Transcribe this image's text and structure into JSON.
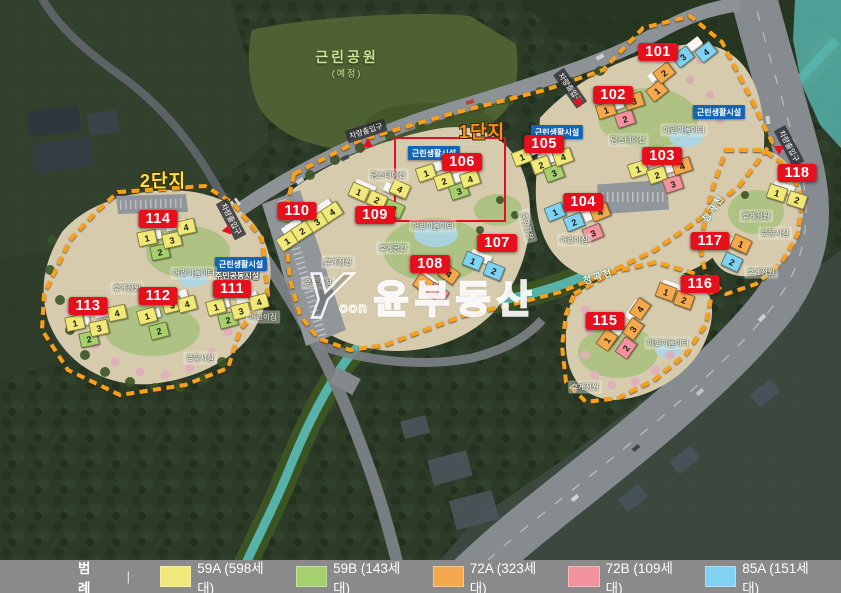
{
  "legend": {
    "title": "범례",
    "divider": "|",
    "items": [
      {
        "code": "59A",
        "label": "59A (598세대)",
        "color": "#f0e878"
      },
      {
        "code": "59B",
        "label": "59B (143세대)",
        "color": "#a6cf6d"
      },
      {
        "code": "72A",
        "label": "72A (323세대)",
        "color": "#f5a94e"
      },
      {
        "code": "72B",
        "label": "72B (109세대)",
        "color": "#f2929e"
      },
      {
        "code": "85A",
        "label": "85A (151세대)",
        "color": "#80d2f2"
      }
    ]
  },
  "watermark": {
    "logo": "Y",
    "logo_sub": "oon",
    "text": "윤부동산"
  },
  "type_colors": {
    "59A": "#f0e878",
    "59B": "#a6cf6d",
    "72A": "#f5a94e",
    "72B": "#f2929e",
    "85A": "#80d2f2"
  },
  "highlight": {
    "building": "106",
    "x": 394,
    "y": 137,
    "w": 108,
    "h": 81,
    "color": "#e6101d"
  },
  "badge_color": "#e6101d",
  "boundary_color": "#f7a01d",
  "buildings": [
    {
      "id": "101",
      "badge": [
        658,
        52
      ],
      "angle": -38,
      "units": [
        {
          "n": "1",
          "t": "72A",
          "x": 657,
          "y": 91
        },
        {
          "n": "2",
          "t": "72A",
          "x": 664,
          "y": 73
        },
        {
          "n": "3",
          "t": "85A",
          "x": 683,
          "y": 57
        },
        {
          "n": "4",
          "t": "85A",
          "x": 706,
          "y": 52
        }
      ]
    },
    {
      "id": "102",
      "badge": [
        613,
        95
      ],
      "angle": -18,
      "units": [
        {
          "n": "1",
          "t": "72A",
          "x": 606,
          "y": 110
        },
        {
          "n": "2",
          "t": "72B",
          "x": 625,
          "y": 119
        },
        {
          "n": "3",
          "t": "72A",
          "x": 634,
          "y": 101
        }
      ]
    },
    {
      "id": "103",
      "badge": [
        662,
        156
      ],
      "angle": -18,
      "units": [
        {
          "n": "1",
          "t": "59A",
          "x": 638,
          "y": 169
        },
        {
          "n": "2",
          "t": "59A",
          "x": 657,
          "y": 175
        },
        {
          "n": "3",
          "t": "72B",
          "x": 673,
          "y": 184
        },
        {
          "n": "4",
          "t": "72A",
          "x": 682,
          "y": 166
        }
      ]
    },
    {
      "id": "104",
      "badge": [
        583,
        202
      ],
      "angle": -22,
      "units": [
        {
          "n": "1",
          "t": "85A",
          "x": 555,
          "y": 212
        },
        {
          "n": "2",
          "t": "85A",
          "x": 574,
          "y": 222
        },
        {
          "n": "3",
          "t": "72B",
          "x": 593,
          "y": 233
        },
        {
          "n": "4",
          "t": "72A",
          "x": 600,
          "y": 212
        }
      ]
    },
    {
      "id": "105",
      "badge": [
        544,
        144
      ],
      "angle": -20,
      "units": [
        {
          "n": "1",
          "t": "59A",
          "x": 522,
          "y": 157
        },
        {
          "n": "2",
          "t": "59A",
          "x": 541,
          "y": 165
        },
        {
          "n": "3",
          "t": "59B",
          "x": 554,
          "y": 173
        },
        {
          "n": "4",
          "t": "59A",
          "x": 563,
          "y": 157
        }
      ]
    },
    {
      "id": "106",
      "badge": [
        462,
        162
      ],
      "angle": -18,
      "units": [
        {
          "n": "1",
          "t": "59A",
          "x": 426,
          "y": 173
        },
        {
          "n": "2",
          "t": "59A",
          "x": 444,
          "y": 181
        },
        {
          "n": "3",
          "t": "59B",
          "x": 459,
          "y": 191
        },
        {
          "n": "4",
          "t": "59A",
          "x": 470,
          "y": 179
        }
      ]
    },
    {
      "id": "107",
      "badge": [
        497,
        243
      ],
      "angle": 22,
      "units": [
        {
          "n": "1",
          "t": "85A",
          "x": 473,
          "y": 261
        },
        {
          "n": "2",
          "t": "85A",
          "x": 494,
          "y": 271
        }
      ]
    },
    {
      "id": "108",
      "badge": [
        430,
        264
      ],
      "angle": 35,
      "units": [
        {
          "n": "1",
          "t": "72A",
          "x": 424,
          "y": 284
        },
        {
          "n": "3",
          "t": "72B",
          "x": 438,
          "y": 293
        },
        {
          "n": "4",
          "t": "72A",
          "x": 449,
          "y": 274
        }
      ]
    },
    {
      "id": "109",
      "badge": [
        375,
        215
      ],
      "angle": 24,
      "units": [
        {
          "n": "1",
          "t": "59A",
          "x": 359,
          "y": 192
        },
        {
          "n": "2",
          "t": "59A",
          "x": 377,
          "y": 200
        },
        {
          "n": "3",
          "t": "59B",
          "x": 394,
          "y": 209
        },
        {
          "n": "4",
          "t": "59A",
          "x": 400,
          "y": 189
        }
      ]
    },
    {
      "id": "110",
      "badge": [
        297,
        211
      ],
      "angle": -33,
      "units": [
        {
          "n": "1",
          "t": "59A",
          "x": 287,
          "y": 241
        },
        {
          "n": "2",
          "t": "59A",
          "x": 302,
          "y": 231
        },
        {
          "n": "3",
          "t": "59A",
          "x": 317,
          "y": 222
        },
        {
          "n": "4",
          "t": "59A",
          "x": 332,
          "y": 212
        }
      ]
    },
    {
      "id": "111",
      "badge": [
        232,
        289
      ],
      "angle": -15,
      "units": [
        {
          "n": "1",
          "t": "59A",
          "x": 216,
          "y": 307
        },
        {
          "n": "2",
          "t": "59B",
          "x": 228,
          "y": 320
        },
        {
          "n": "3",
          "t": "59A",
          "x": 241,
          "y": 311
        },
        {
          "n": "4",
          "t": "59A",
          "x": 259,
          "y": 302
        }
      ]
    },
    {
      "id": "112",
      "badge": [
        158,
        296
      ],
      "angle": -15,
      "units": [
        {
          "n": "1",
          "t": "59A",
          "x": 147,
          "y": 316
        },
        {
          "n": "2",
          "t": "59B",
          "x": 159,
          "y": 331
        },
        {
          "n": "3",
          "t": "59A",
          "x": 172,
          "y": 305
        },
        {
          "n": "4",
          "t": "59A",
          "x": 187,
          "y": 304
        }
      ]
    },
    {
      "id": "113",
      "badge": [
        88,
        306
      ],
      "angle": -12,
      "units": [
        {
          "n": "1",
          "t": "59A",
          "x": 75,
          "y": 323
        },
        {
          "n": "2",
          "t": "59B",
          "x": 89,
          "y": 339
        },
        {
          "n": "3",
          "t": "59A",
          "x": 99,
          "y": 328
        },
        {
          "n": "4",
          "t": "59A",
          "x": 117,
          "y": 313
        }
      ]
    },
    {
      "id": "114",
      "badge": [
        158,
        219
      ],
      "angle": -12,
      "units": [
        {
          "n": "1",
          "t": "59A",
          "x": 147,
          "y": 238
        },
        {
          "n": "2",
          "t": "59B",
          "x": 160,
          "y": 252
        },
        {
          "n": "3",
          "t": "59A",
          "x": 172,
          "y": 240
        },
        {
          "n": "4",
          "t": "59A",
          "x": 186,
          "y": 227
        }
      ]
    },
    {
      "id": "115",
      "badge": [
        605,
        321
      ],
      "angle": -55,
      "units": [
        {
          "n": "1",
          "t": "72A",
          "x": 607,
          "y": 340
        },
        {
          "n": "2",
          "t": "72B",
          "x": 626,
          "y": 348
        },
        {
          "n": "3",
          "t": "72A",
          "x": 633,
          "y": 329
        },
        {
          "n": "4",
          "t": "72A",
          "x": 640,
          "y": 309
        }
      ]
    },
    {
      "id": "116",
      "badge": [
        700,
        284
      ],
      "angle": 20,
      "units": [
        {
          "n": "1",
          "t": "72A",
          "x": 666,
          "y": 292
        },
        {
          "n": "2",
          "t": "72A",
          "x": 684,
          "y": 300
        }
      ]
    },
    {
      "id": "117",
      "badge": [
        710,
        241
      ],
      "angle": 25,
      "units": [
        {
          "n": "1",
          "t": "72A",
          "x": 741,
          "y": 244
        },
        {
          "n": "2",
          "t": "85A",
          "x": 732,
          "y": 262
        }
      ]
    },
    {
      "id": "118",
      "badge": [
        797,
        173
      ],
      "angle": 18,
      "units": [
        {
          "n": "1",
          "t": "59A",
          "x": 777,
          "y": 193
        },
        {
          "n": "2",
          "t": "59A",
          "x": 797,
          "y": 200
        }
      ]
    }
  ],
  "map_labels": [
    {
      "text": "2단지",
      "type": "zone2",
      "x": 163,
      "y": 180
    },
    {
      "text": "1단지",
      "type": "zone1",
      "x": 482,
      "y": 131
    },
    {
      "text": "근린공원",
      "type": "park",
      "x": 347,
      "y": 57
    },
    {
      "text": "(예정)",
      "type": "park-sub",
      "x": 347,
      "y": 73
    },
    {
      "text": "차량출입구",
      "type": "entrance",
      "x": 231,
      "y": 219,
      "rot": 62
    },
    {
      "text": "차량출입구",
      "type": "entrance",
      "x": 366,
      "y": 131,
      "rot": -18
    },
    {
      "text": "차량출입구",
      "type": "entrance",
      "x": 570,
      "y": 88,
      "rot": 55
    },
    {
      "text": "차량출입구",
      "type": "entrance",
      "x": 789,
      "y": 146,
      "rot": 62
    },
    {
      "text": "근린생활시설",
      "type": "facility",
      "x": 241,
      "y": 264
    },
    {
      "text": "근린생활시설",
      "type": "facility",
      "x": 434,
      "y": 153
    },
    {
      "text": "근린생활시설",
      "type": "facility",
      "x": 557,
      "y": 132
    },
    {
      "text": "근린생활시설",
      "type": "facility",
      "x": 719,
      "y": 112
    },
    {
      "text": "주민공동시설",
      "type": "outline",
      "x": 237,
      "y": 276
    },
    {
      "text": "어린이놀이터",
      "type": "ground",
      "x": 194,
      "y": 273
    },
    {
      "text": "어린이놀이터",
      "type": "ground",
      "x": 433,
      "y": 226
    },
    {
      "text": "어린이놀이터",
      "type": "ground",
      "x": 684,
      "y": 130
    },
    {
      "text": "어린이놀이터",
      "type": "ground",
      "x": 668,
      "y": 343
    },
    {
      "text": "휴게정원",
      "type": "ground",
      "x": 127,
      "y": 288
    },
    {
      "text": "휴게정원",
      "type": "ground",
      "x": 338,
      "y": 262
    },
    {
      "text": "휴게정원",
      "type": "ground",
      "x": 756,
      "y": 216
    },
    {
      "text": "휴게정원",
      "type": "ground",
      "x": 761,
      "y": 272
    },
    {
      "text": "휴게정원",
      "type": "ground",
      "x": 585,
      "y": 387
    },
    {
      "text": "운동시설",
      "type": "ground",
      "x": 200,
      "y": 358
    },
    {
      "text": "운동시설",
      "type": "ground",
      "x": 318,
      "y": 283
    },
    {
      "text": "운동시설",
      "type": "ground",
      "x": 775,
      "y": 233
    },
    {
      "text": "어린이집",
      "type": "ground",
      "x": 263,
      "y": 317
    },
    {
      "text": "어린이집",
      "type": "ground",
      "x": 574,
      "y": 240
    },
    {
      "text": "맘스테이션",
      "type": "ground",
      "x": 388,
      "y": 175
    },
    {
      "text": "맘스테이션",
      "type": "ground",
      "x": 628,
      "y": 140
    },
    {
      "text": "휴게공간",
      "type": "ground",
      "x": 393,
      "y": 248
    },
    {
      "text": "중앙광장",
      "type": "ground",
      "x": 527,
      "y": 226,
      "rot": 75
    },
    {
      "text": "청곡천",
      "type": "stream",
      "x": 598,
      "y": 276,
      "rot": -18
    },
    {
      "text": "청곡천",
      "type": "stream",
      "x": 713,
      "y": 208,
      "rot": -55
    }
  ],
  "entrance_markers": [
    {
      "x": 228,
      "y": 229,
      "rot": 200
    },
    {
      "x": 368,
      "y": 143,
      "rot": 180
    },
    {
      "x": 579,
      "y": 101,
      "rot": 215
    },
    {
      "x": 779,
      "y": 151,
      "rot": 0
    }
  ]
}
